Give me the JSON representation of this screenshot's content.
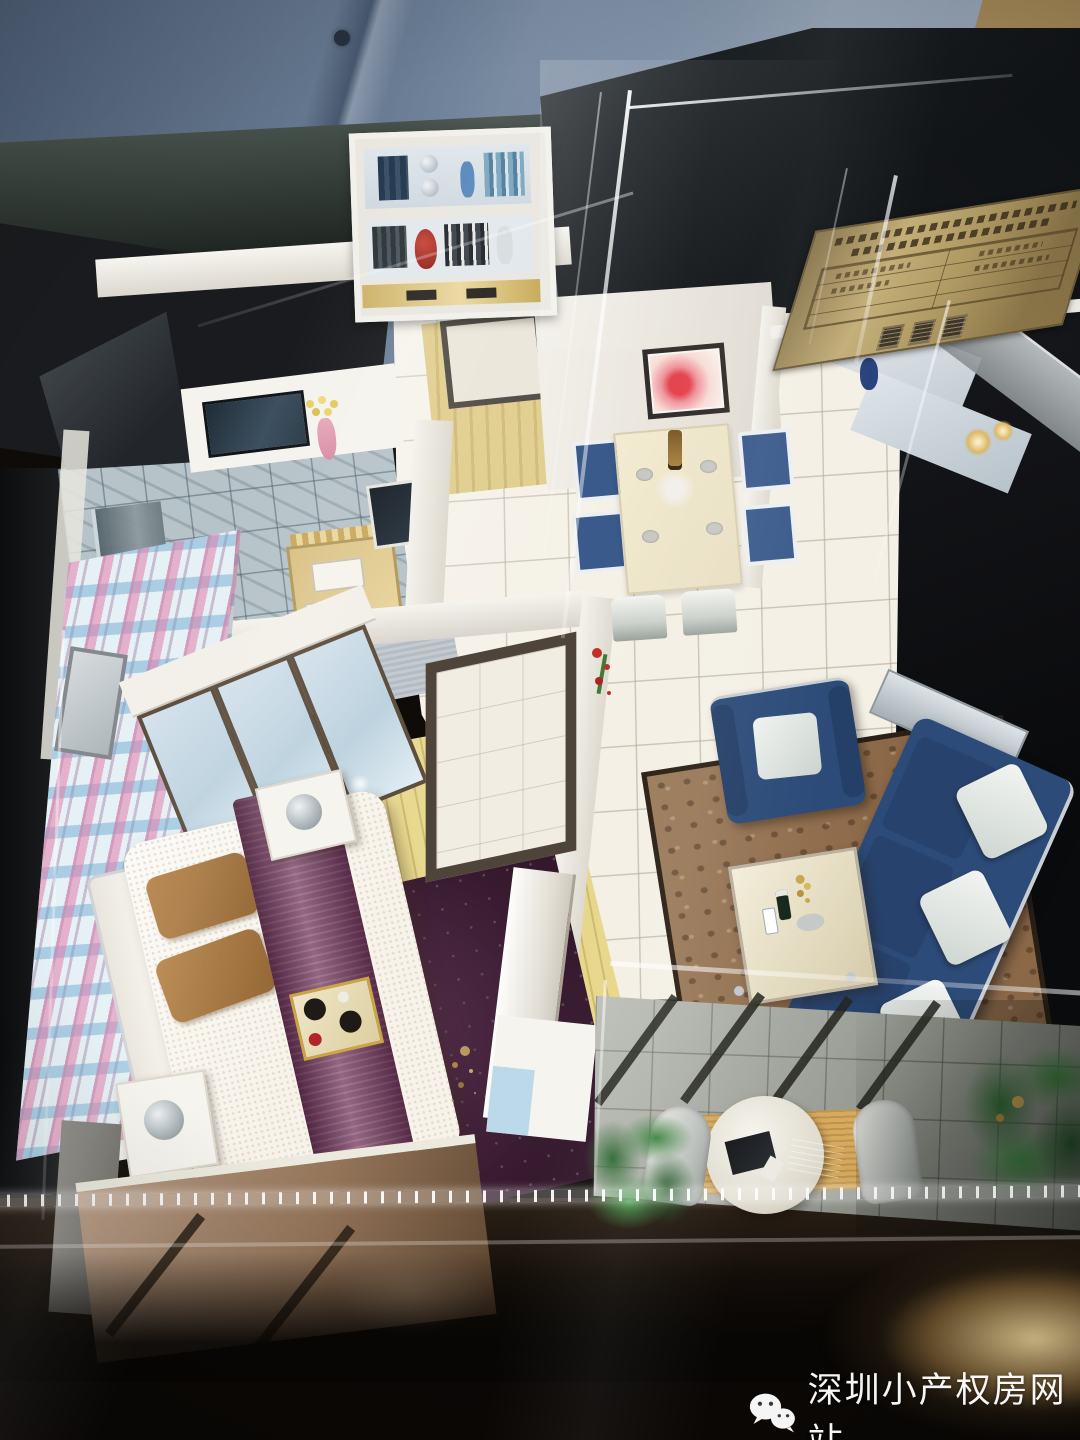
{
  "watermark": {
    "icon": "wechat-icon",
    "text": "深圳小产权房网站",
    "text_color": "#ffffff"
  },
  "display_case": {
    "plaque": {
      "material_color": "#b29a5c",
      "engraving_color": "#3e362a",
      "header_lines": 2,
      "table_rows": 4,
      "table_columns": 2,
      "title_glyphs": 3,
      "legibility": "blurred-illegible"
    }
  },
  "palette": {
    "case_table": "#16100b",
    "flare_warm": "#f4d696",
    "shirt_reflection_blue": "#72859c",
    "wall_reflection_tan": "#c5ae86",
    "model_wall": "#f2efe8",
    "tile_floor": "#f4f0e5",
    "wood_floor": "#e7d78b",
    "marble_floor": "#b6c3c9",
    "plaque_brass": "#b29a5c",
    "acrylic_highlight": "#ffffff"
  },
  "model_rooms": {
    "bedroom": {
      "bed": "#f7f3ea",
      "runner": "#7c4467",
      "pillows": "#a87848",
      "rug": "#34182c",
      "accent_wall_pink": "#e17daa",
      "accent_wall_blue": "#6eaad2",
      "wardrobe_doors": "#c6d8e4"
    },
    "living_room": {
      "sofa": "#2c4b78",
      "cushions": "#e9ece9",
      "rug": "#8b6848",
      "coffee_table": "#ece4cc"
    },
    "dining_room": {
      "table": "#eee6c9",
      "chairs": "#3a5a8c",
      "wall_art": "#e4454f"
    },
    "bathroom": {
      "tile": "#b6c3c9",
      "vanity": "#d9c083",
      "tv": "#2a3a46"
    },
    "balcony": {
      "floor": "#a9ada3",
      "mat": "#d7aa5e",
      "table": "#efede4",
      "laptops": "#17191c",
      "plants": "#37743a"
    },
    "entry": {
      "bookshelf": "#e9e7e0",
      "red_vase": "#a42b22"
    }
  }
}
